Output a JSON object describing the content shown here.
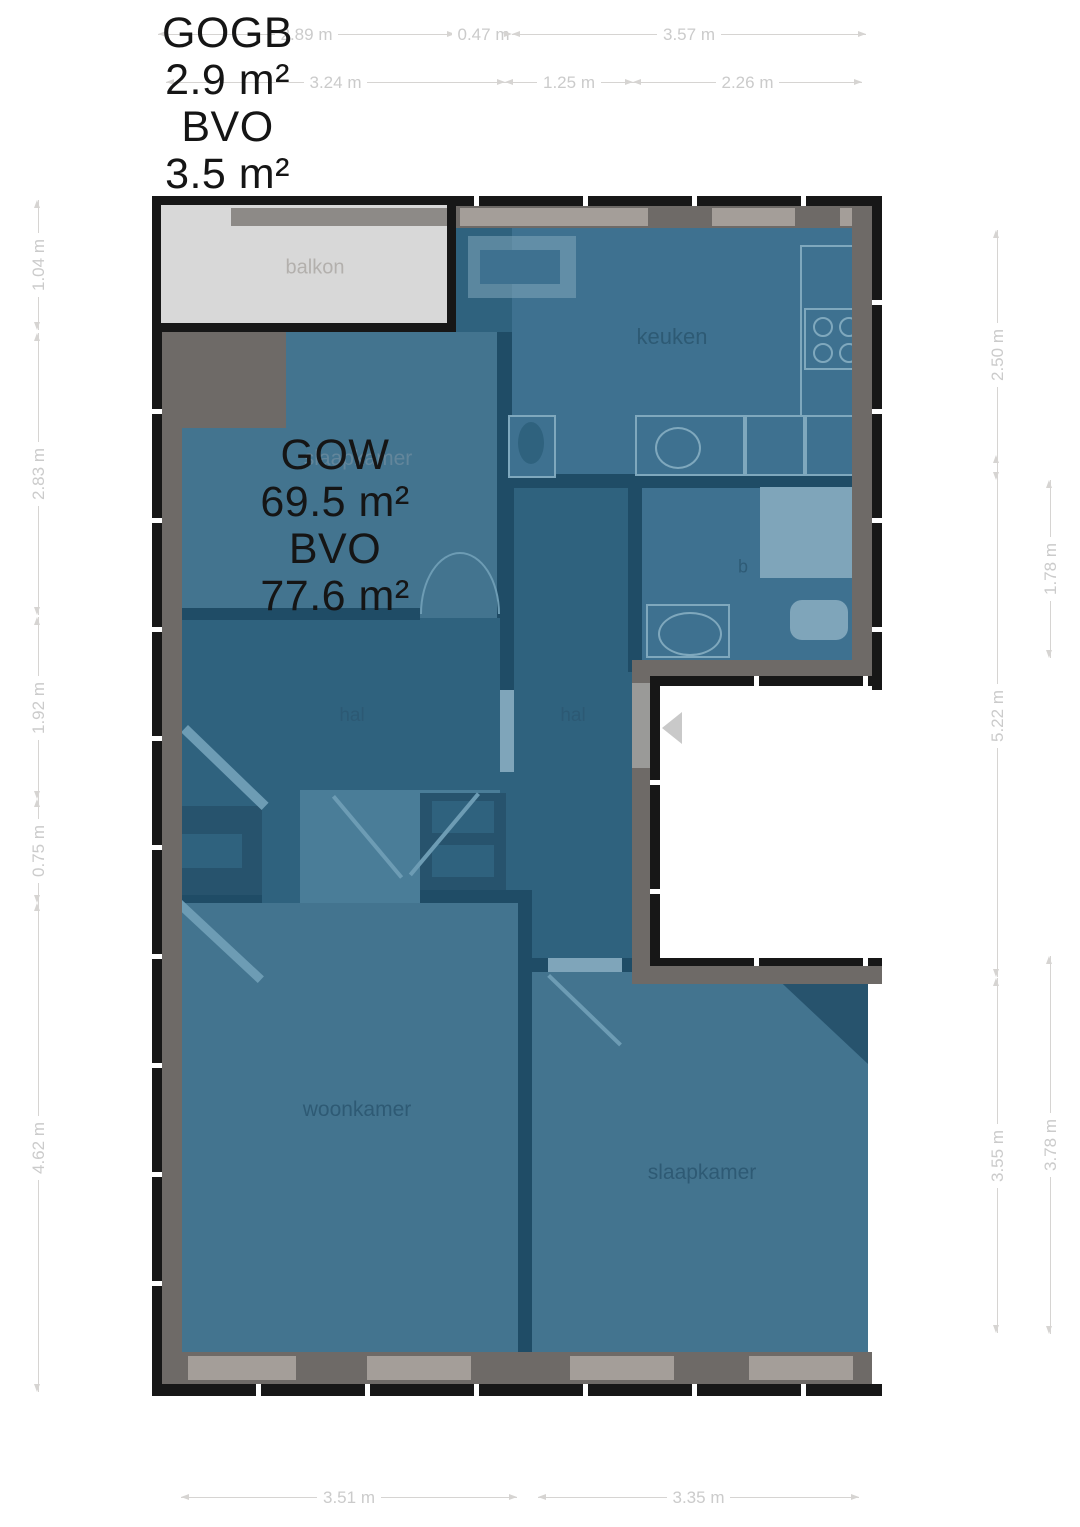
{
  "overlays": {
    "gogb": [
      "GOGB",
      "2.9 m²",
      "BVO",
      "3.5 m²"
    ],
    "gow": [
      "GOW",
      "69.5 m²",
      "BVO",
      "77.6 m²"
    ]
  },
  "rooms": {
    "balkon": "balkon",
    "keuken": "keuken",
    "hal_left": "hal",
    "hal_right": "hal",
    "badkamer_partial": "b",
    "woonkamer": "woonkamer",
    "slaapkamer": "slaapkamer",
    "kamer_faint": "slaapkamer"
  },
  "dimensions": {
    "top_outer": [
      {
        "label": "2.89 m"
      },
      {
        "label": "0.47 m"
      },
      {
        "label": "3.57 m"
      }
    ],
    "top_inner": [
      {
        "label": "3.24 m"
      },
      {
        "label": "1.25 m"
      },
      {
        "label": "2.26 m"
      }
    ],
    "left": [
      {
        "label": "1.04 m"
      },
      {
        "label": "2.83 m"
      },
      {
        "label": "1.92 m"
      },
      {
        "label": "0.75 m"
      },
      {
        "label": "4.62 m"
      }
    ],
    "right_outer": [
      {
        "label": "2.50 m"
      },
      {
        "label": "5.22 m"
      },
      {
        "label": "3.55 m"
      }
    ],
    "right_inner": [
      {
        "label": "1.78 m"
      },
      {
        "label": "3.78 m"
      }
    ],
    "bottom": [
      {
        "label": "3.51 m"
      },
      {
        "label": "3.35 m"
      }
    ]
  },
  "colors": {
    "wall_black": "#171717",
    "wall_gray": "#6e6a67",
    "window_gray": "#a49e99",
    "balcony_fill": "#d8d8d8",
    "room_blue": "#43748f",
    "hall_blue": "#2f627e",
    "interior_wall_navy": "#1f4c66",
    "dimension_gray": "#cbcbcb",
    "overlay_text": "#151515"
  }
}
